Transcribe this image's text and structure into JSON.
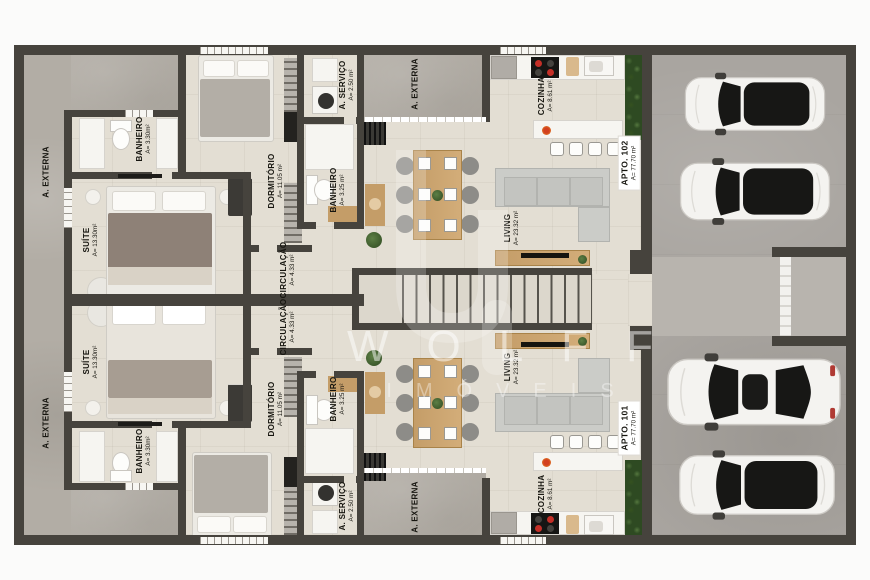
{
  "watermark": {
    "brand": "WOLFF",
    "subtitle": "IMÓVEIS"
  },
  "labels": [
    {
      "name": "A. EXTERNA",
      "area": ""
    },
    {
      "name": "BANHEIRO",
      "area": "A= 3.30m²"
    },
    {
      "name": "SUÍTE",
      "area": "A= 13.30m²"
    },
    {
      "name": "DORMITÓRIO",
      "area": "A= 11.05 m²"
    },
    {
      "name": "CIRCULAÇÃO",
      "area": "A= 4.33 m²"
    },
    {
      "name": "A. SERVIÇO",
      "area": "A= 2.50 m²"
    },
    {
      "name": "A. EXTERNA",
      "area": ""
    },
    {
      "name": "BANHEIRO",
      "area": "A= 3.25 m²"
    },
    {
      "name": "COZINHA",
      "area": "A= 8.61 m²"
    },
    {
      "name": "LIVING",
      "area": "A= 23.32 m²"
    },
    {
      "name": "APTO. 102",
      "area": "A= 77.70 m²"
    },
    {
      "name": "A. EXTERNA",
      "area": ""
    },
    {
      "name": "SUÍTE",
      "area": "A= 13.30m²"
    },
    {
      "name": "BANHEIRO",
      "area": "A= 3.30m²"
    },
    {
      "name": "DORMITÓRIO",
      "area": "A= 11.05 m²"
    },
    {
      "name": "CIRCULAÇÃO",
      "area": "A= 4.33 m²"
    },
    {
      "name": "BANHEIRO",
      "area": "A= 3.25 m²"
    },
    {
      "name": "A. SERVIÇO",
      "area": "A= 2.50 m²"
    },
    {
      "name": "A. EXTERNA",
      "area": ""
    },
    {
      "name": "COZINHA",
      "area": "A= 8.61 m²"
    },
    {
      "name": "LIVING",
      "area": "A= 23.32 m²"
    },
    {
      "name": "APTO. 101",
      "area": "A= 77.70 m²"
    }
  ],
  "garage": {
    "car_count": 4
  },
  "colors": {
    "wall": "#46433d",
    "interior_floor": "#e3ded3",
    "external_concrete": "#b2ada5",
    "garage_floor": "#a9a5a0",
    "hedge_green": "#3f5c31",
    "wood": "#c49d68",
    "car_glass": "#171715",
    "taillight_red": "#b03a33"
  }
}
